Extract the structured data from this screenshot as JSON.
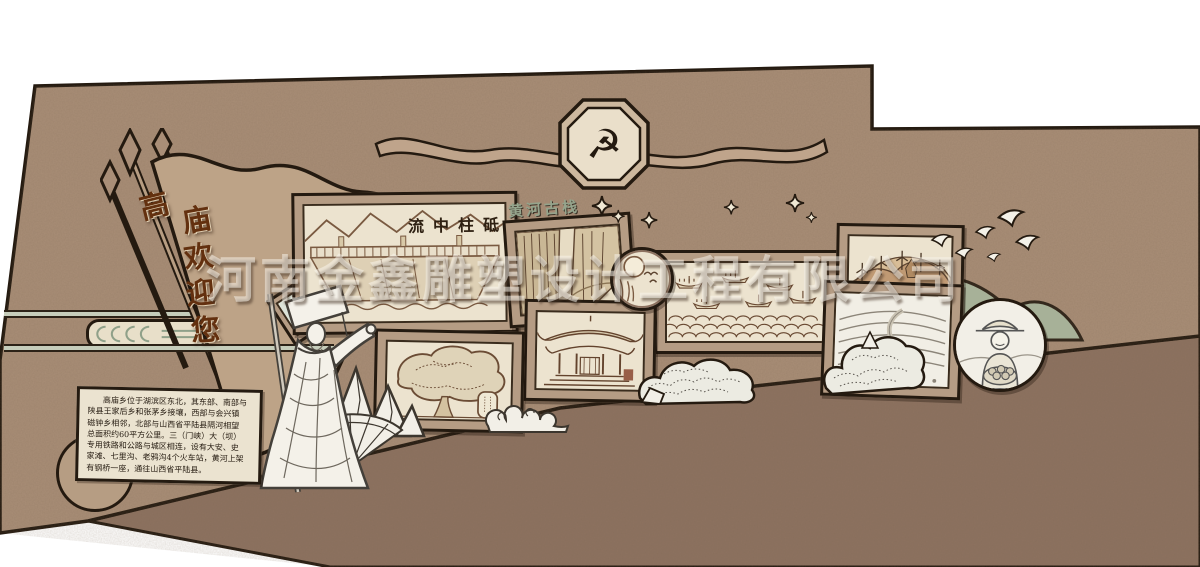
{
  "design": {
    "watermark": "河南金鑫雕塑设计工程有限公司",
    "emblem_symbol": "☭",
    "welcome_pennant": {
      "text": "高庙欢迎您",
      "chars": [
        "高",
        "庙",
        "欢",
        "迎",
        "您"
      ]
    },
    "captions": {
      "dam": "流中柱砥",
      "ancient_plank_road": "黄河古栈"
    },
    "intro_box": {
      "lines": [
        "高庙乡位于湖滨区东北，其东部、南部与",
        "陕县王家后乡和张茅乡接壤，西部与会兴镇",
        "磁钟乡相邻，北部与山西省平陆县隔河相望",
        "总面积约60平方公里。三（门峡）大（坝）",
        "专用铁路和公路与城区相连，设有大安、史",
        "家滩、七里沟、老鸦沟4个火车站，黄河上架",
        "有钢桥一座，通往山西省平陆县。"
      ]
    },
    "colors": {
      "wall": "#a98e77",
      "ground": "#8d7260",
      "outline": "#241a10",
      "panel_frame": "#b59c84",
      "panel_paper": "#ece3cf",
      "mountain_green": "#a7b198",
      "label_green": "#95a48c",
      "calligraphy_brown": "#63300f"
    }
  }
}
